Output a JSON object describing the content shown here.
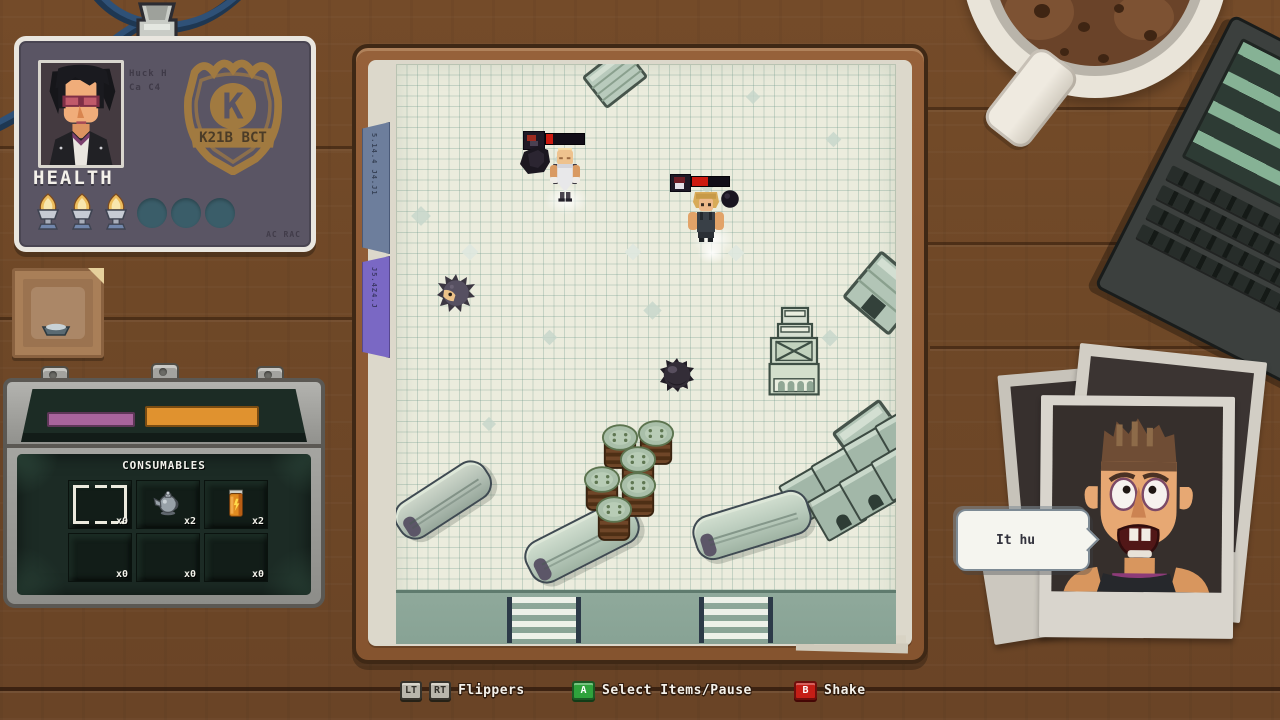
{
  "badge": {
    "name_line1": "Huck H",
    "name_line2": "Ca C4",
    "health_label": "HEALTH",
    "health_filled": 3,
    "health_empty": 3,
    "emblem_letter": "K",
    "emblem_banner": "K21B BCT",
    "serial": "AC RAC"
  },
  "toolbox": {
    "title": "CONSUMABLES",
    "slots": [
      {
        "item": "empty-selected",
        "count": "x0"
      },
      {
        "item": "teapot",
        "count": "x2"
      },
      {
        "item": "soda-can",
        "count": "x2"
      },
      {
        "item": "empty",
        "count": "x0"
      },
      {
        "item": "empty",
        "count": "x0"
      },
      {
        "item": "empty",
        "count": "x0"
      }
    ]
  },
  "board": {
    "tabs": [
      {
        "label": "5.14.4 J4.J1"
      },
      {
        "label": "J5.4Z4.J"
      }
    ],
    "enemies": [
      {
        "id": "butcher",
        "health_pct": 18
      },
      {
        "id": "brawler",
        "health_pct": 42
      }
    ]
  },
  "speech_bubble": {
    "text": "It hu"
  },
  "controls": {
    "flippers": {
      "key_left": "LT",
      "key_right": "RT",
      "label": "Flippers"
    },
    "select": {
      "key": "A",
      "label": "Select Items/Pause"
    },
    "shake": {
      "key": "B",
      "label": "Shake"
    }
  },
  "colors": {
    "key_green": "#2fa33c",
    "key_red": "#c41e16",
    "health_red": "#cc1a10",
    "lid_bar_purple": "#a8649c",
    "lid_bar_orange": "#e0922f"
  }
}
